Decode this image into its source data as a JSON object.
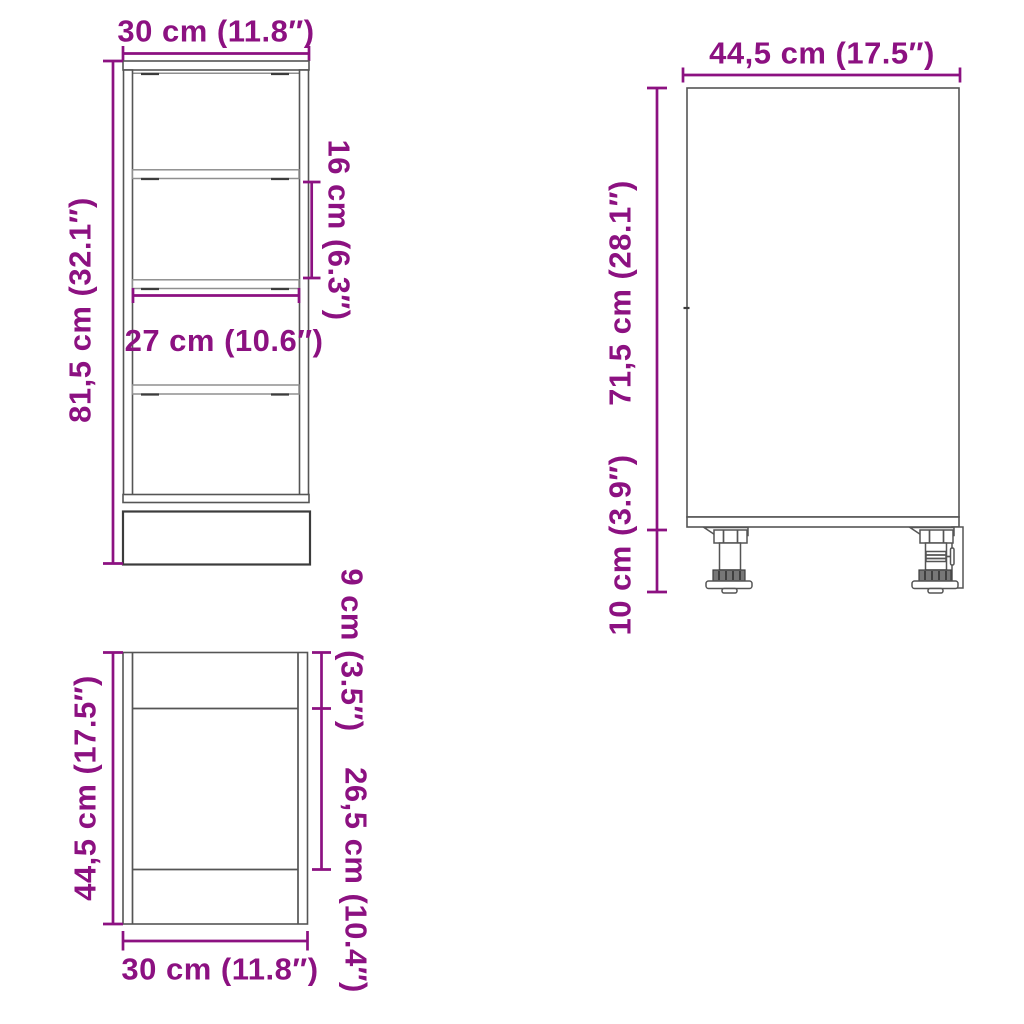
{
  "colors": {
    "dimension": "#8C1181",
    "outline": "#555555",
    "outline_dark": "#3c3c3c",
    "shelf_line": "#8f8f8f",
    "background": "#ffffff"
  },
  "front_view": {
    "width_label": "30 cm (11.8″)",
    "height_label": "81,5 cm (32.1″)",
    "shelf_gap_label": "16 cm (6.3″)",
    "inner_width_label": "27 cm (10.6″)"
  },
  "side_view": {
    "depth_label": "44,5 cm (17.5″)",
    "body_height_label": "71,5 cm (28.1″)",
    "leg_height_label": "10 cm (3.9″)"
  },
  "top_view": {
    "depth_label": "44,5 cm (17.5″)",
    "width_label": "30 cm (11.8″)",
    "front_section_label": "9 cm (3.5″)",
    "middle_section_label": "26,5 cm (10.4″)"
  }
}
